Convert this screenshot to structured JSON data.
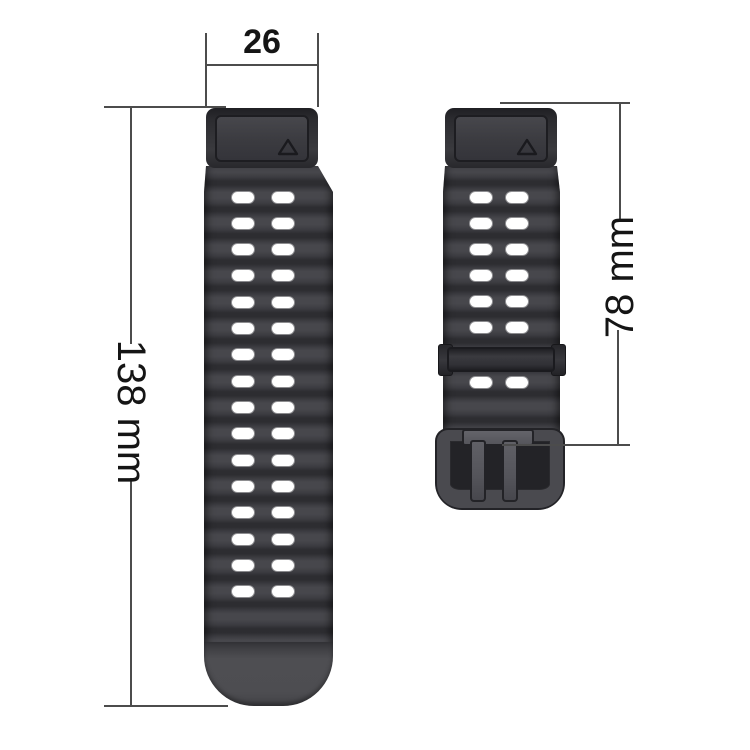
{
  "diagram": {
    "type": "watch-band-dimension-diagram",
    "labels": {
      "connector_width": "26",
      "long_strap_length": "138 mm",
      "short_strap_length": "78 mm"
    },
    "parts": {
      "long_strap": {
        "name": "long strap with holes",
        "hole_rows": 16,
        "hole_row_start_y": 197,
        "hole_row_step": 26.33,
        "hole_columns_x": [
          243,
          283
        ]
      },
      "short_strap": {
        "name": "short strap with keeper and buckle",
        "hole_rows_y": [
          197,
          223,
          249,
          275,
          301,
          327,
          382
        ],
        "hole_columns_x": [
          481,
          517
        ]
      }
    },
    "icons": {
      "connector_mark": "triangle-outline"
    },
    "colors": {
      "background": "#ffffff",
      "strap": "#3e3e42",
      "strap_ridge_dark": "#2d2d31",
      "strap_highlight": "#47474c",
      "end_cap": "#4d4d51",
      "keeper": "#313136",
      "buckle": "#4a4a4f",
      "pin": "#55555b",
      "dimension_line": "#4c4c4c",
      "label_text": "#151515"
    }
  }
}
